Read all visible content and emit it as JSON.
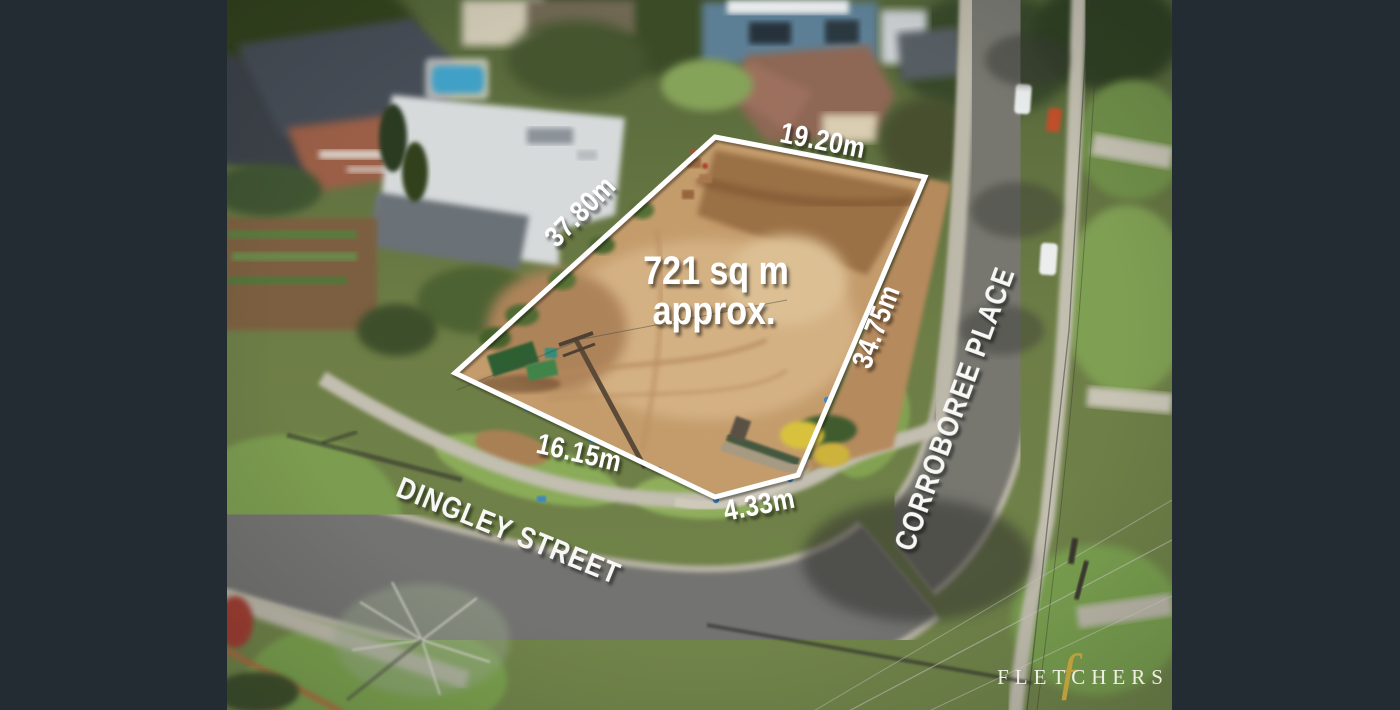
{
  "page": {
    "letterbox_color": "#232c33"
  },
  "overlay": {
    "boundary_color": "#ffffff",
    "area_line1": "721 sq m",
    "area_line2": "approx.",
    "dimensions": {
      "top": "19.20m",
      "left": "37.80m",
      "right": "34.75m",
      "bottom": "16.15m",
      "splay": "4.33m"
    },
    "streets": {
      "bottom": "DINGLEY STREET",
      "right": "CORROBOREE PLACE"
    }
  },
  "watermark": {
    "brand": "FLETCHERS",
    "monogram": "ƒ",
    "brand_color": "#f7f5ee",
    "monogram_color": "#c2a03c"
  }
}
